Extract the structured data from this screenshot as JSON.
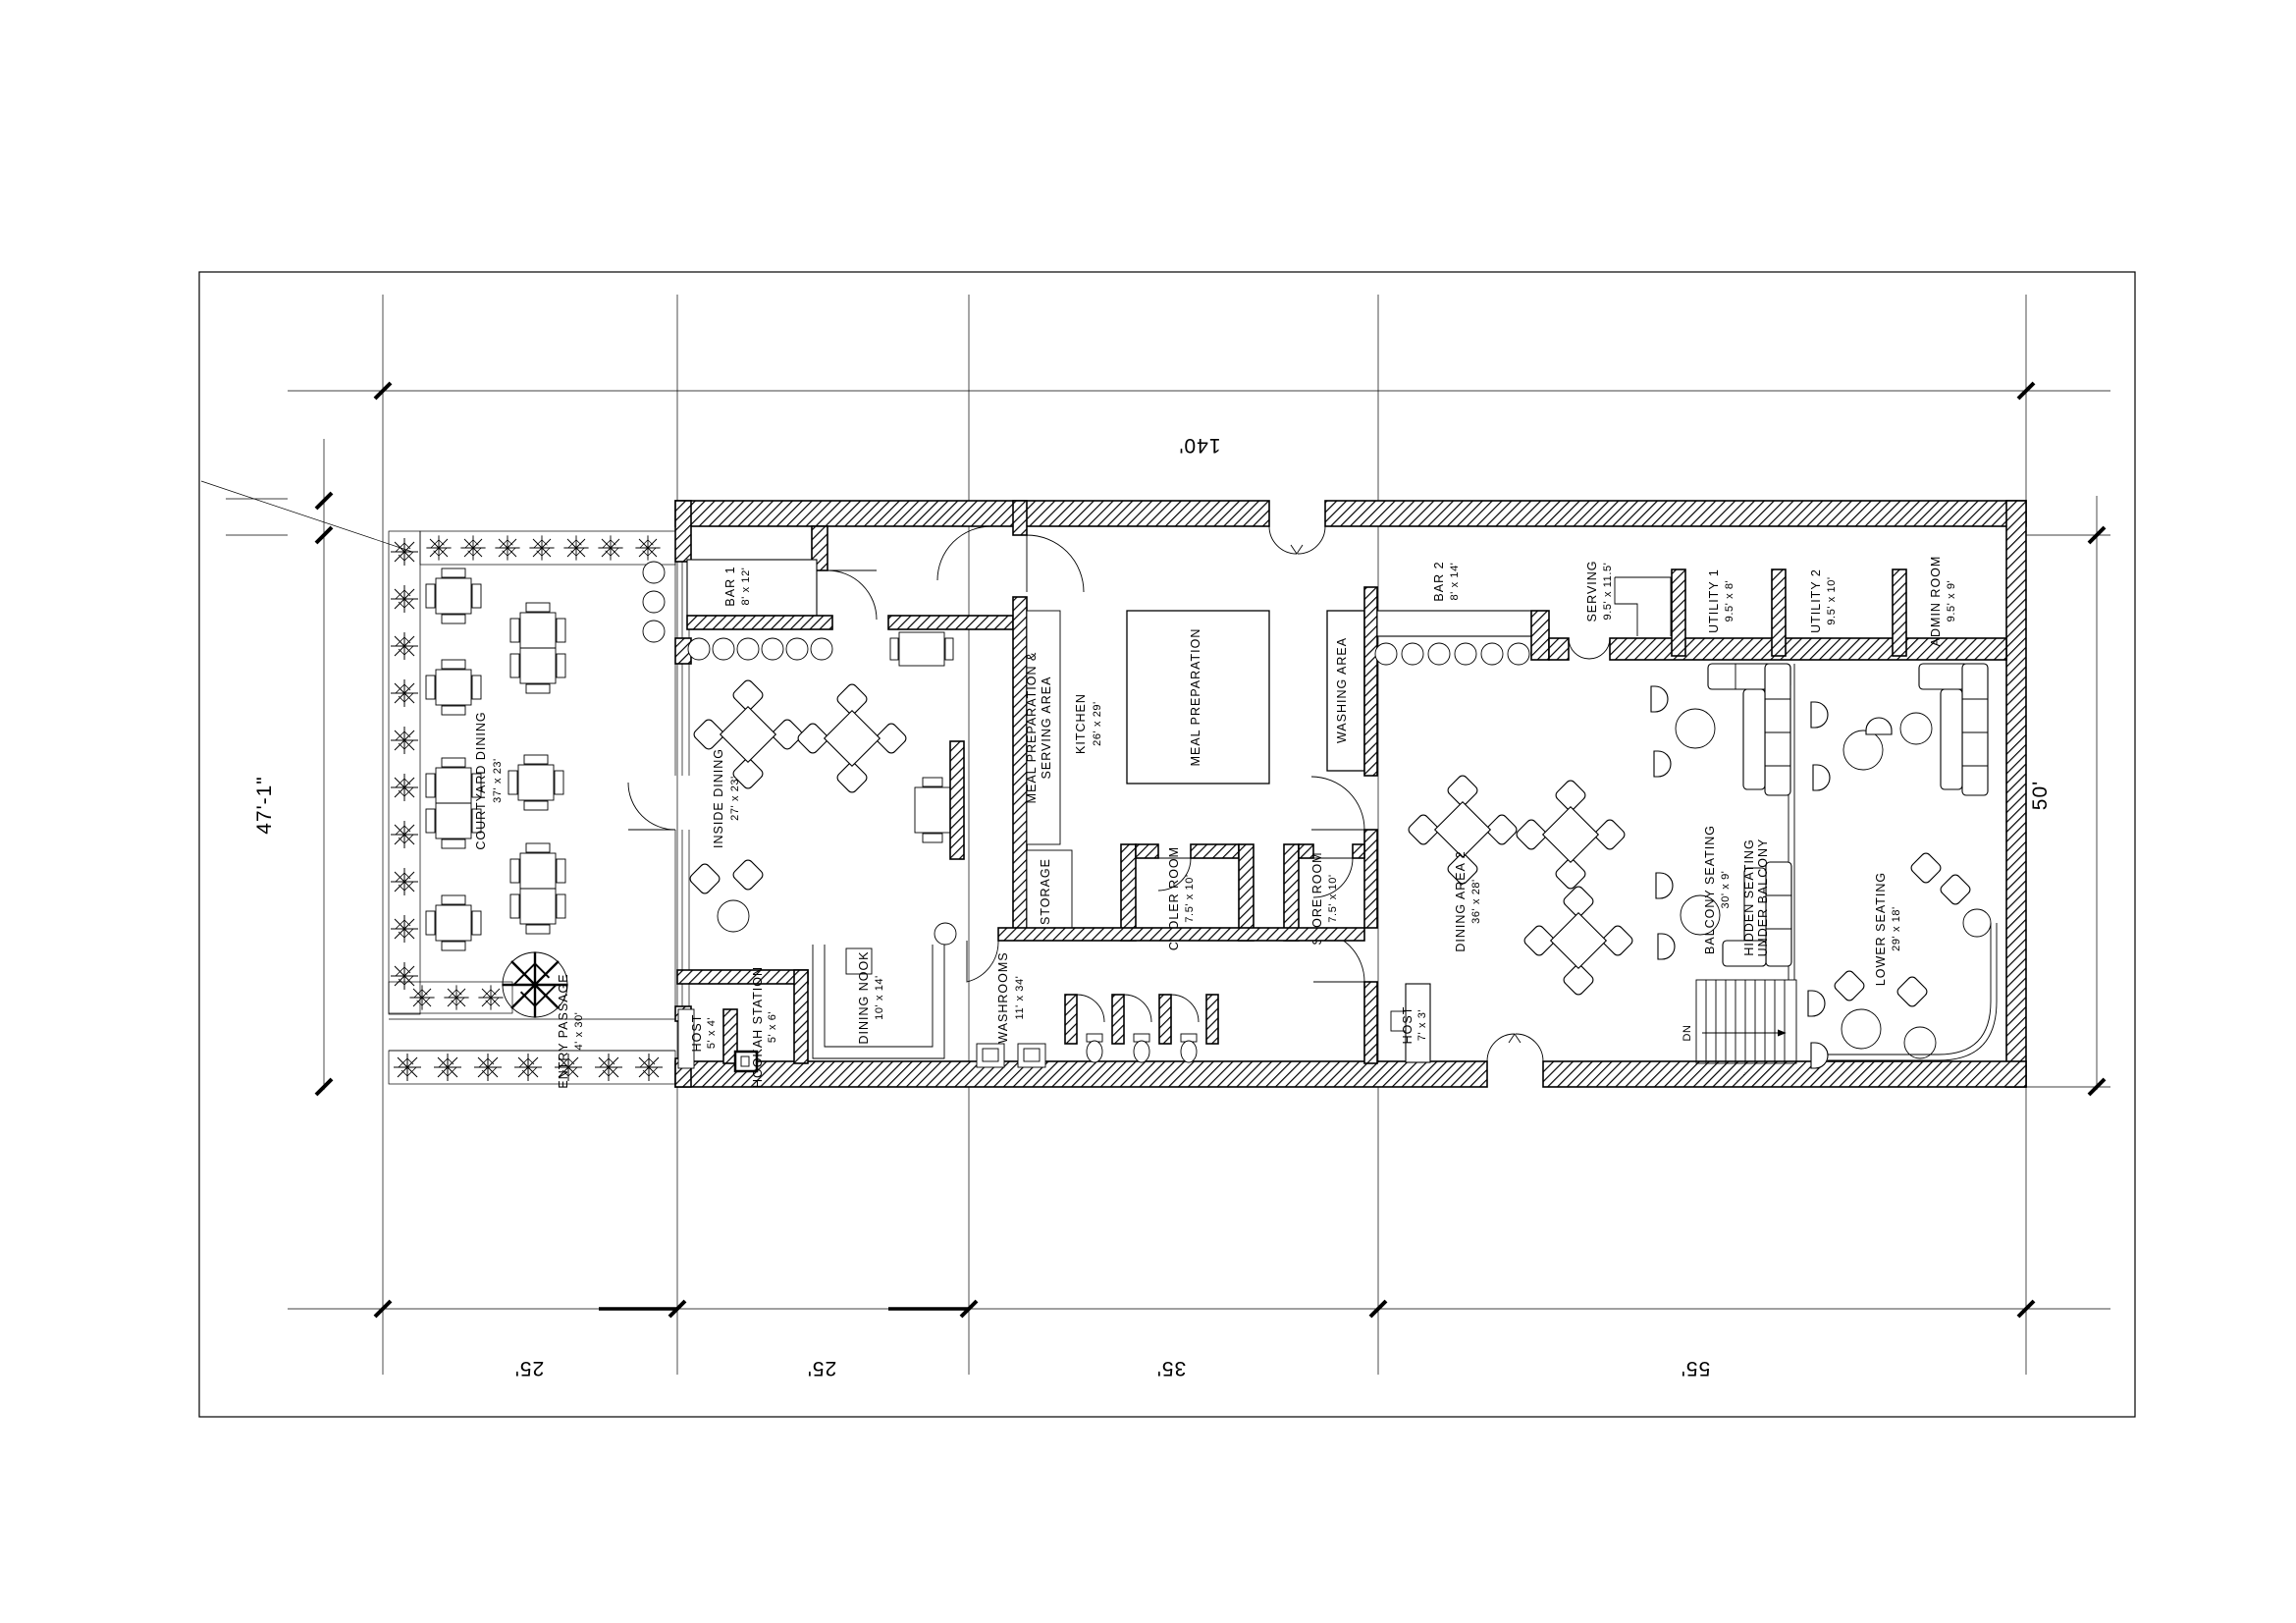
{
  "drawing": {
    "dimensions": {
      "top_width": "140'",
      "left_height": "47'-1\"",
      "right_height": "50'",
      "bottom": [
        "25'",
        "25'",
        "35'",
        "55'"
      ]
    },
    "rooms": {
      "courtyard_dining": {
        "name": "COURTYARD DINING",
        "size": "37' x 23'"
      },
      "entry_passage": {
        "name": "ENTRY PASSAGE",
        "size": "4' x 30'"
      },
      "bar1": {
        "name": "BAR 1",
        "size": "8' x 12'"
      },
      "inside_dining": {
        "name": "INSIDE DINING",
        "size": "27' x 23'"
      },
      "host_left": {
        "name": "HOST",
        "size": "5' x 4'"
      },
      "hookah_station": {
        "name": "HOOKAH STATION",
        "size": "5' x 6'"
      },
      "dining_nook": {
        "name": "DINING NOOK",
        "size": "10' x 14'"
      },
      "washrooms": {
        "name": "WASHROOMS",
        "size": "11' x 34'"
      },
      "meal_prep_serving": {
        "line1": "MEAL PREPARATION &",
        "line2": "SERVING AREA"
      },
      "storage": {
        "name": "STORAGE"
      },
      "kitchen": {
        "name": "KITCHEN",
        "size": "26' x 29'"
      },
      "meal_preparation": {
        "name": "MEAL PREPARATION"
      },
      "washing_area": {
        "name": "WASHING AREA"
      },
      "cooler_room": {
        "name": "COOLER ROOM",
        "size": "7.5' x 10'"
      },
      "store_room": {
        "name": "STORE ROOM",
        "size": "7.5' x 10'"
      },
      "bar2": {
        "name": "BAR 2",
        "size": "8' x 14'"
      },
      "serving": {
        "name": "SERVING",
        "size": "9.5' x 11.5'"
      },
      "utility1": {
        "name": "UTILITY 1",
        "size": "9.5' x 8'"
      },
      "utility2": {
        "name": "UTILITY 2",
        "size": "9.5' x 10'"
      },
      "admin_room": {
        "name": "ADMIN ROOM",
        "size": "9.5' x 9'"
      },
      "dining_area2": {
        "name": "DINING AREA 2",
        "size": "36' x 28'"
      },
      "balcony_seating": {
        "name": "BALCONY SEATING",
        "size": "30' x 9'"
      },
      "hidden_seating": {
        "line1": "HIDDEN SEATING",
        "line2": "UNDER BALCONY"
      },
      "lower_seating": {
        "name": "LOWER SEATING",
        "size": "29' x 18'"
      },
      "host_main": {
        "name": "HOST",
        "size": "7' x 3'"
      },
      "stairs": {
        "label": "DN"
      }
    }
  }
}
